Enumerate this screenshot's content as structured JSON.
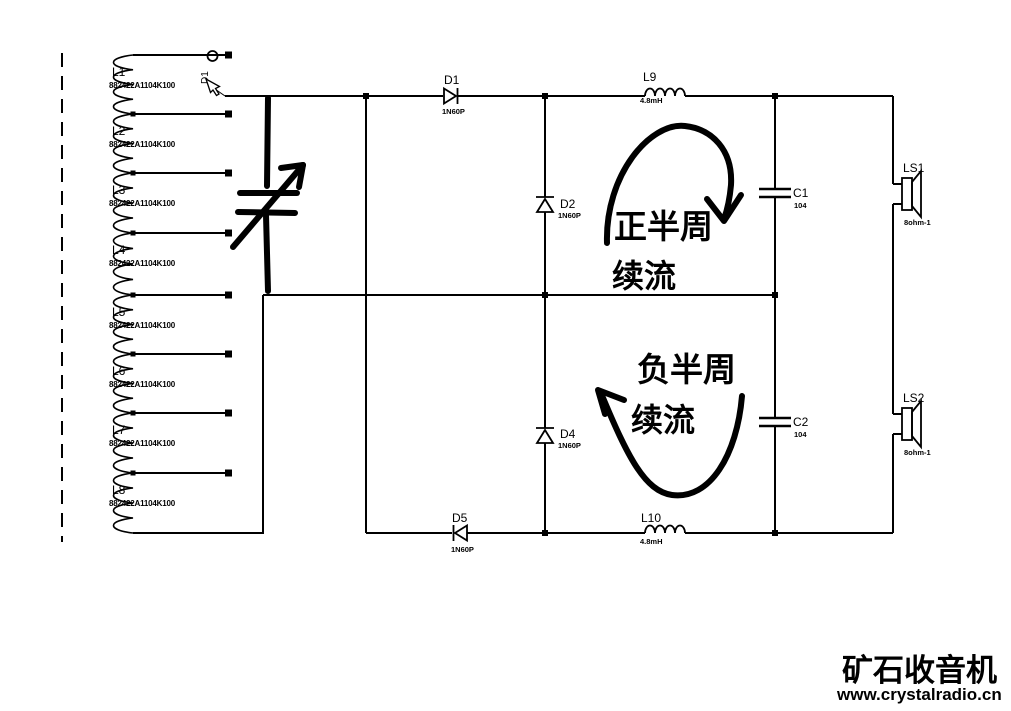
{
  "page": {
    "background": "#ffffff",
    "ink": "#000000"
  },
  "tank": {
    "sections": [
      {
        "ref": "L1",
        "part": "882422A1104K100"
      },
      {
        "ref": "L2",
        "part": "882422A1104K100"
      },
      {
        "ref": "L3",
        "part": "882422A1104K100"
      },
      {
        "ref": "L4",
        "part": "882422A1104K100"
      },
      {
        "ref": "L5",
        "part": "882422A1104K100"
      },
      {
        "ref": "L6",
        "part": "882422A1104K100"
      },
      {
        "ref": "L7",
        "part": "882422A1104K100"
      },
      {
        "ref": "L8",
        "part": "882422A1104K100"
      }
    ]
  },
  "parts": {
    "d1": {
      "ref": "D1",
      "type": "1N60P"
    },
    "d2": {
      "ref": "D2",
      "type": "1N60P"
    },
    "d4": {
      "ref": "D4",
      "type": "1N60P"
    },
    "d5": {
      "ref": "D5",
      "type": "1N60P"
    },
    "l9": {
      "ref": "L9",
      "value": "4.8mH"
    },
    "l10": {
      "ref": "L10",
      "value": "4.8mH"
    },
    "c1": {
      "ref": "C1",
      "value": "104"
    },
    "c2": {
      "ref": "C2",
      "value": "104"
    },
    "ls1": {
      "ref": "LS1",
      "value": "8ohm-1"
    },
    "ls2": {
      "ref": "LS2",
      "value": "8ohm-1"
    }
  },
  "cursor": {
    "pending_ref": "D1"
  },
  "annotations": {
    "positive_half": {
      "line1": "正半周",
      "line2": "续流"
    },
    "negative_half": {
      "line1": "负半周",
      "line2": "续流"
    }
  },
  "watermark": {
    "site_name": "矿石收音机",
    "site_url": "www.crystalradio.cn",
    "color": "#17497d"
  }
}
